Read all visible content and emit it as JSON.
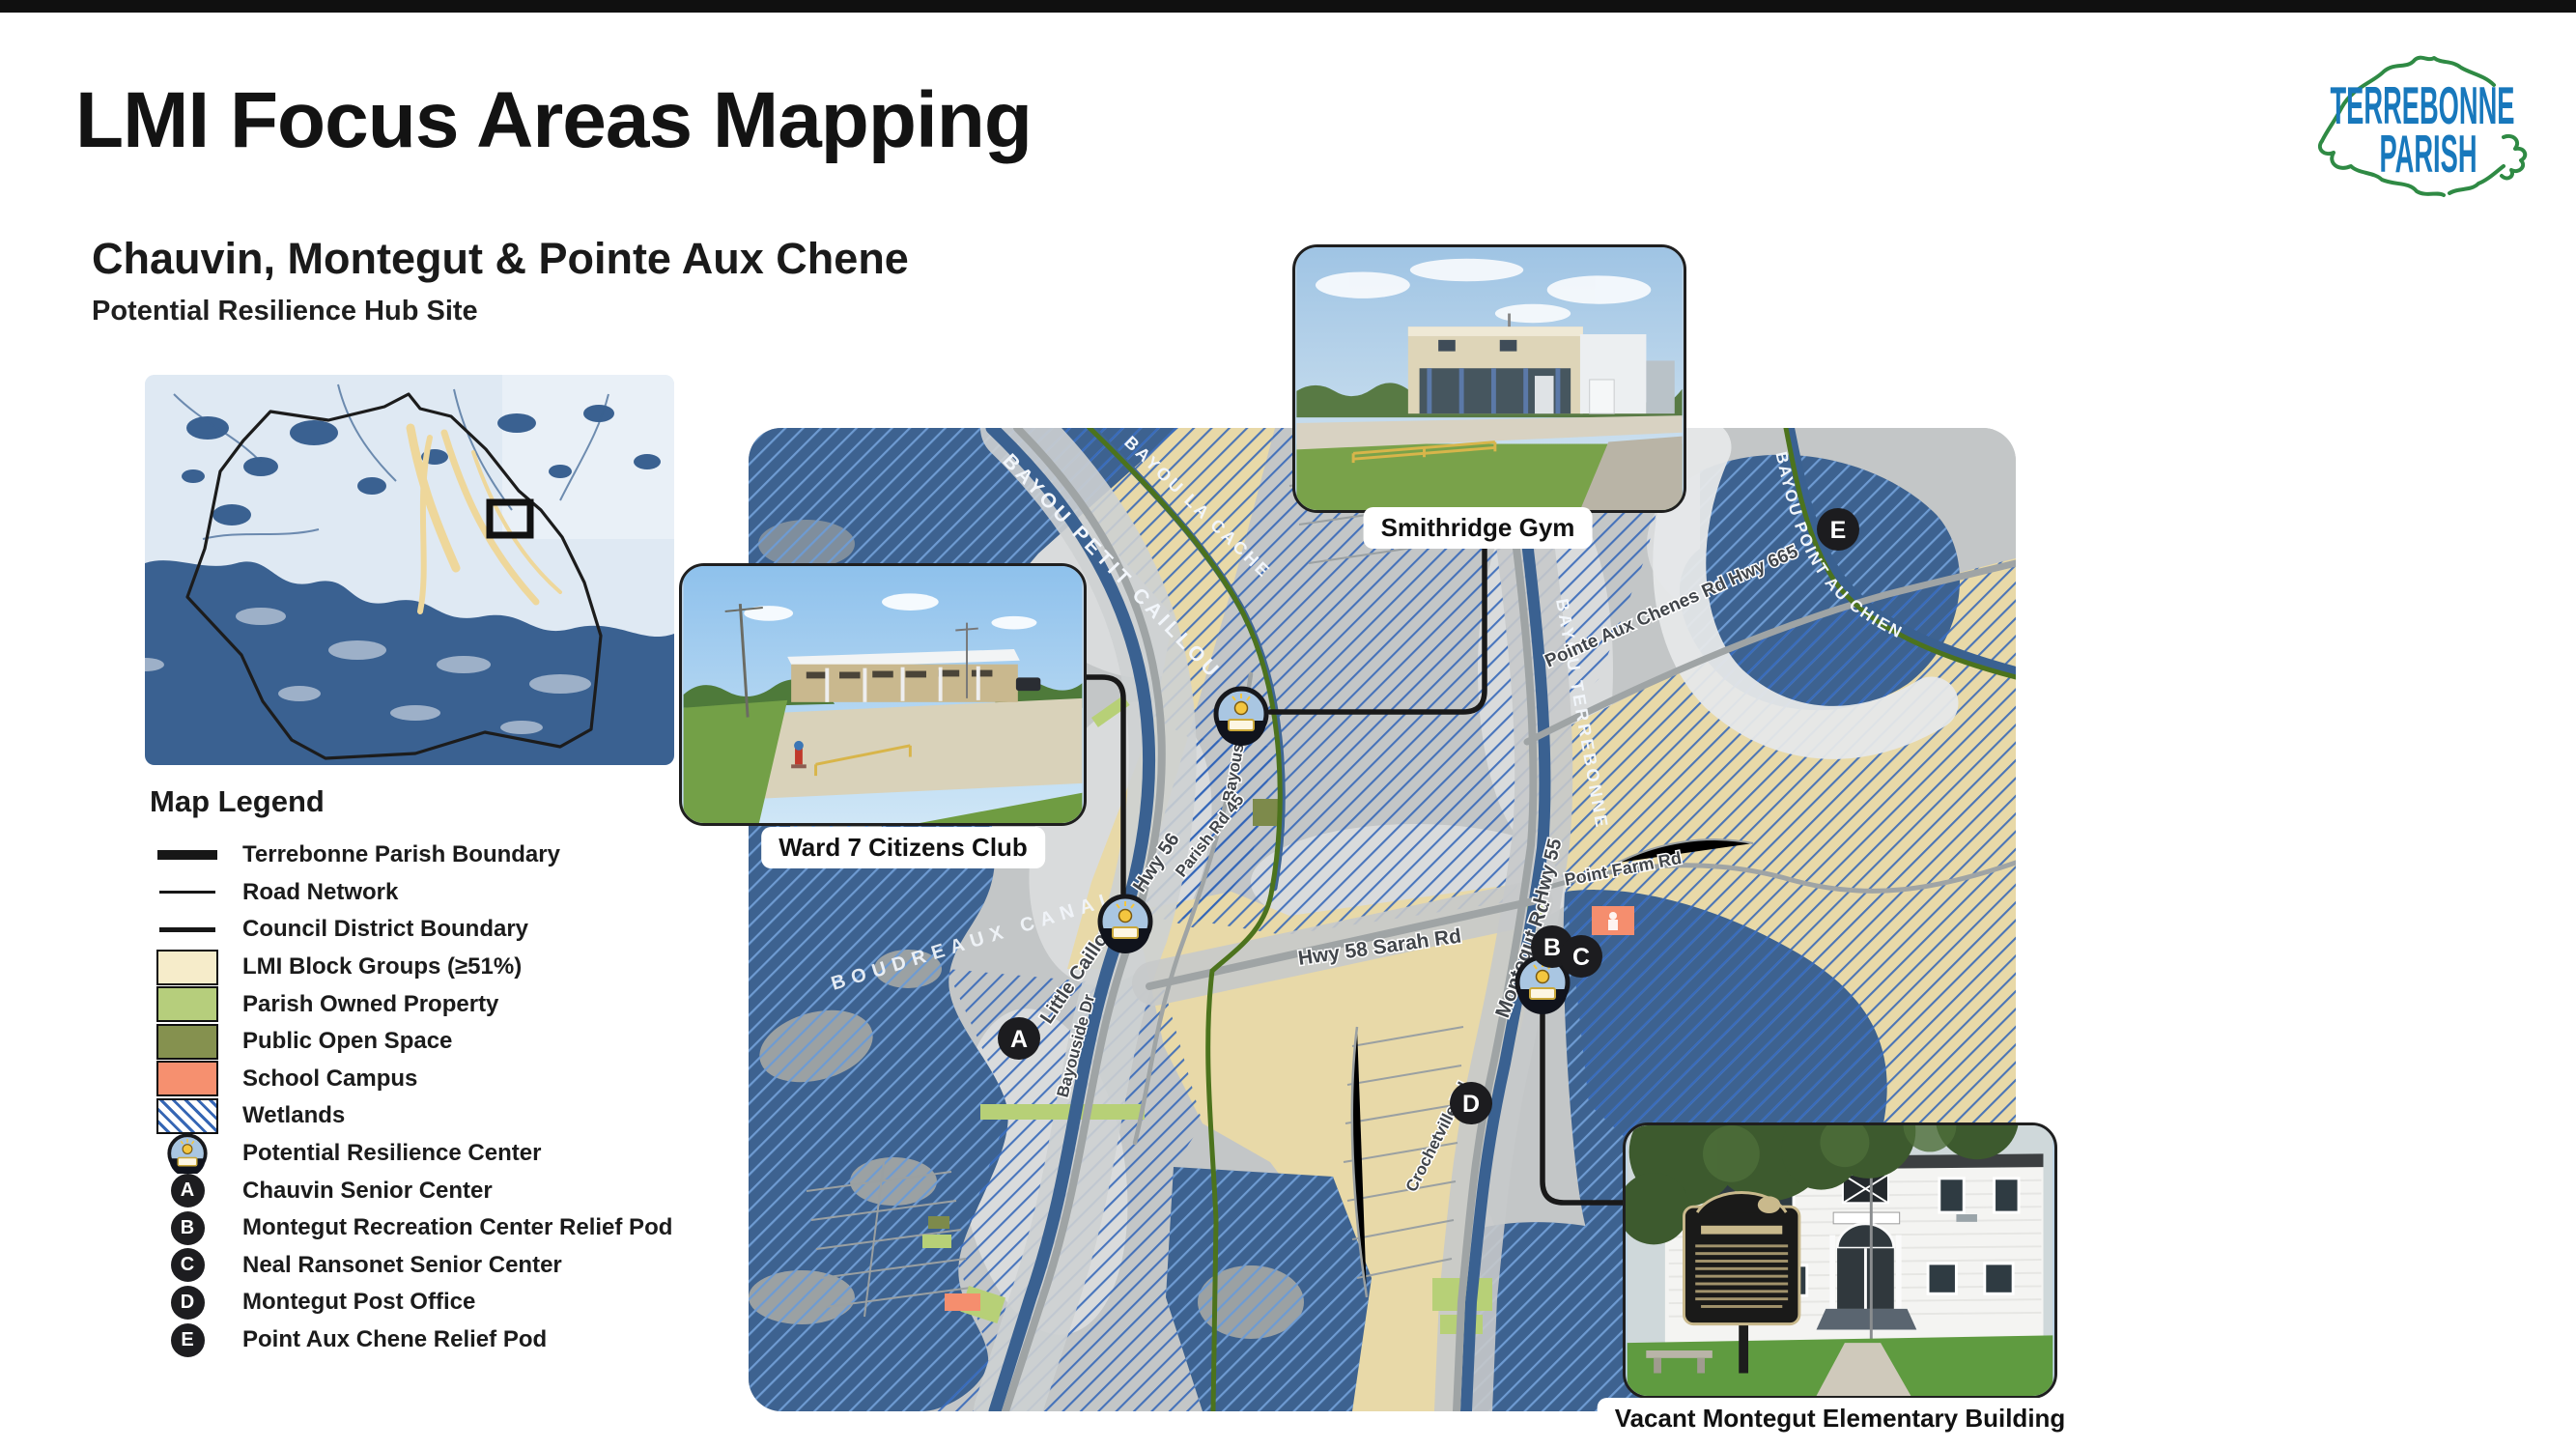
{
  "page": {
    "title": "LMI Focus Areas Mapping"
  },
  "brand": {
    "line1": "TERREBONNE",
    "line2": "PARISH"
  },
  "section": {
    "heading": "Chauvin, Montegut & Pointe Aux Chene",
    "subheading": "Potential Resilience Hub Site"
  },
  "legend": {
    "title": "Map Legend",
    "items": [
      {
        "label": "Terrebonne Parish Boundary"
      },
      {
        "label": "Road Network"
      },
      {
        "label": "Council District Boundary"
      },
      {
        "label": "LMI Block Groups (≥51%)",
        "color": "#f6ecca"
      },
      {
        "label": "Parish Owned Property",
        "color": "#b6ce7c"
      },
      {
        "label": "Public Open Space",
        "color": "#85914f"
      },
      {
        "label": "School Campus",
        "color": "#f6906f"
      },
      {
        "label": "Wetlands",
        "color": "#3566b4"
      },
      {
        "label": "Potential Resilience Center"
      },
      {
        "key": "A",
        "label": "Chauvin Senior Center"
      },
      {
        "key": "B",
        "label": "Montegut Recreation Center Relief Pod"
      },
      {
        "key": "C",
        "label": "Neal Ransonet Senior Center"
      },
      {
        "key": "D",
        "label": "Montegut Post Office"
      },
      {
        "key": "E",
        "label": "Point Aux Chene Relief Pod"
      }
    ]
  },
  "map": {
    "callouts": [
      {
        "label": "Smithridge Gym"
      },
      {
        "label": "Ward 7 Citizens Club"
      },
      {
        "label": "Vacant Montegut Elementary Building"
      }
    ],
    "road_labels": [
      "Hwy 56",
      "Little Caillou Rd",
      "Bayouside Dr",
      "Parish Rd 45",
      "Hwy 58 Sarah Rd",
      "Montegut Rd",
      "Hwy 55",
      "Point Farm Rd",
      "Pointe Aux Chenes Rd  Hwy 665",
      "Crochetville Rd"
    ],
    "water_labels": [
      "BAYOU PETIT CAILLOU",
      "BAYOU LA CACHE",
      "BOUDREAUX CANAL",
      "BAYOU TERREBONNE",
      "BAYOU POINT AU CHIEN"
    ],
    "markers": [
      {
        "letter": "A"
      },
      {
        "letter": "B"
      },
      {
        "letter": "C"
      },
      {
        "letter": "D"
      },
      {
        "letter": "E"
      }
    ]
  },
  "colors": {
    "water": "#3d6290",
    "wetland_hatch": "#2f63b8",
    "lmi": "#e8d9a8",
    "parish_property": "#b7d077",
    "open_space": "#7d8a4b",
    "school": "#f58e6e",
    "council_line": "#4c731d",
    "brand_blue": "#1878bc",
    "brand_green": "#2f8a44"
  }
}
